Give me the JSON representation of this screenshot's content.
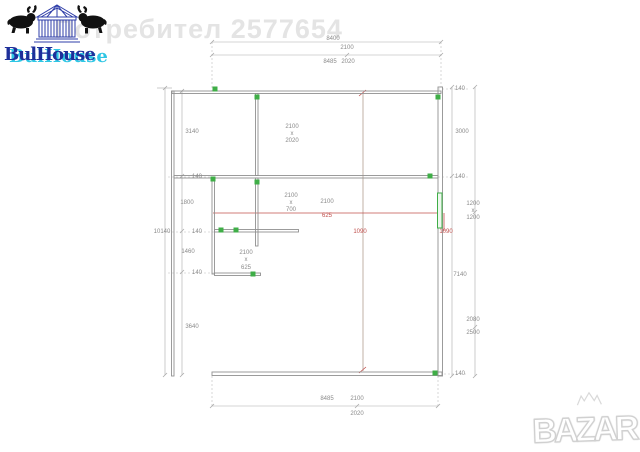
{
  "watermark": {
    "text": "Потребител 2577654"
  },
  "logo_bulhouse": {
    "text": "BulHouse"
  },
  "logo_bazar": {
    "text": "BAZAR"
  },
  "theme": {
    "wall": "#919191",
    "dim": "#a9a9a9",
    "ext": "#bdbdbd",
    "dimtext": "#8a8a8a",
    "green": "#3fae47",
    "red": "#c0504d",
    "section": "#a79081",
    "watermark": "#e4e4e4",
    "navy": "#1e2f9a",
    "cyan": "#2fc6e4",
    "bazar_outline": "#d0d0d0"
  },
  "plan": {
    "labels": [
      {
        "t": "8400",
        "x": 333,
        "y": 39
      },
      {
        "t": "2100",
        "x": 347,
        "y": 48
      },
      {
        "t": "8485",
        "x": 330,
        "y": 62
      },
      {
        "t": "2020",
        "x": 348,
        "y": 62
      },
      {
        "t": "8485",
        "x": 327,
        "y": 399
      },
      {
        "t": "2100",
        "x": 357,
        "y": 399
      },
      {
        "t": "2020",
        "x": 357,
        "y": 414
      },
      {
        "t": "10140",
        "x": 162,
        "y": 232
      },
      {
        "t": "3140",
        "x": 192,
        "y": 132
      },
      {
        "t": "140",
        "x": 197,
        "y": 177
      },
      {
        "t": "1800",
        "x": 187,
        "y": 203
      },
      {
        "t": "140",
        "x": 197,
        "y": 232
      },
      {
        "t": "1460",
        "x": 188,
        "y": 252
      },
      {
        "t": "140",
        "x": 197,
        "y": 273
      },
      {
        "t": "3640",
        "x": 192,
        "y": 327
      },
      {
        "t": "140",
        "x": 460,
        "y": 89
      },
      {
        "t": "3000",
        "x": 462,
        "y": 132
      },
      {
        "t": "140",
        "x": 460,
        "y": 177
      },
      {
        "t": "1200",
        "x": 473,
        "y": 204
      },
      {
        "t": "x",
        "x": 473,
        "y": 211
      },
      {
        "t": "1200",
        "x": 473,
        "y": 218
      },
      {
        "t": "7140",
        "x": 460,
        "y": 275
      },
      {
        "t": "2080",
        "x": 473,
        "y": 320
      },
      {
        "t": "2500",
        "x": 473,
        "y": 333
      },
      {
        "t": "140",
        "x": 460,
        "y": 374
      },
      {
        "t": "2100",
        "x": 292,
        "y": 127
      },
      {
        "t": "x",
        "x": 292,
        "y": 134
      },
      {
        "t": "2020",
        "x": 292,
        "y": 141
      },
      {
        "t": "2100",
        "x": 291,
        "y": 196
      },
      {
        "t": "x",
        "x": 291,
        "y": 203
      },
      {
        "t": "700",
        "x": 291,
        "y": 210
      },
      {
        "t": "2100",
        "x": 327,
        "y": 202
      },
      {
        "t": "625",
        "x": 327,
        "y": 216,
        "c": "red"
      },
      {
        "t": "2100",
        "x": 246,
        "y": 253
      },
      {
        "t": "x",
        "x": 246,
        "y": 260
      },
      {
        "t": "625",
        "x": 246,
        "y": 268
      },
      {
        "t": "1090",
        "x": 360,
        "y": 232,
        "c": "red"
      },
      {
        "t": "1090",
        "x": 446,
        "y": 232,
        "c": "red"
      }
    ]
  }
}
